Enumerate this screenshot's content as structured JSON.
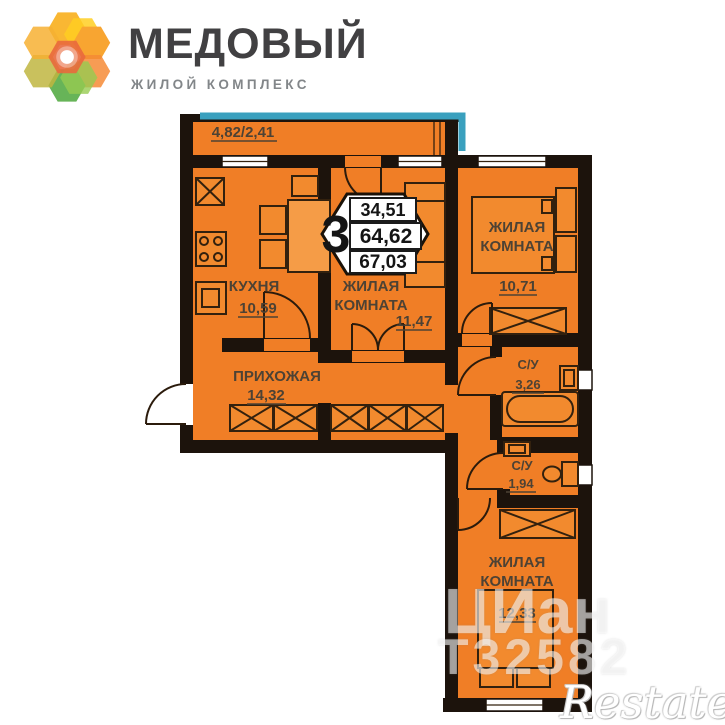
{
  "header": {
    "title": "МЕДОВЫЙ",
    "subtitle": "ЖИЛОЙ КОМПЛЕКС"
  },
  "plan": {
    "balcony_label": "4,82/2,41",
    "badge": {
      "rooms_count": "3",
      "living_area": "34,51",
      "area": "64,62",
      "total_area": "67,03"
    },
    "rooms": {
      "kitchen": {
        "name": "КУХНЯ",
        "area": "10,59"
      },
      "hallway": {
        "name": "ПРИХОЖАЯ",
        "area": "14,32"
      },
      "living_center": {
        "line1": "ЖИЛАЯ",
        "line2": "КОМНАТА",
        "area": "11,47"
      },
      "living_right": {
        "line1": "ЖИЛАЯ",
        "line2": "КОМНАТА",
        "area": "10,71"
      },
      "bathroom": {
        "name": "С/У",
        "area": "3,26"
      },
      "toilet": {
        "name": "С/У",
        "area": "1,94"
      },
      "living_bottom": {
        "line1": "ЖИЛАЯ",
        "line2": "КОМНАТА",
        "area": "12,33"
      }
    },
    "colors": {
      "floor": "#F07E26",
      "wall": "#1C130C",
      "accent": "#3AA0BE"
    }
  },
  "watermarks": {
    "cian": "ЦИан",
    "listing_id": "Т32582",
    "restate": "Restate"
  }
}
